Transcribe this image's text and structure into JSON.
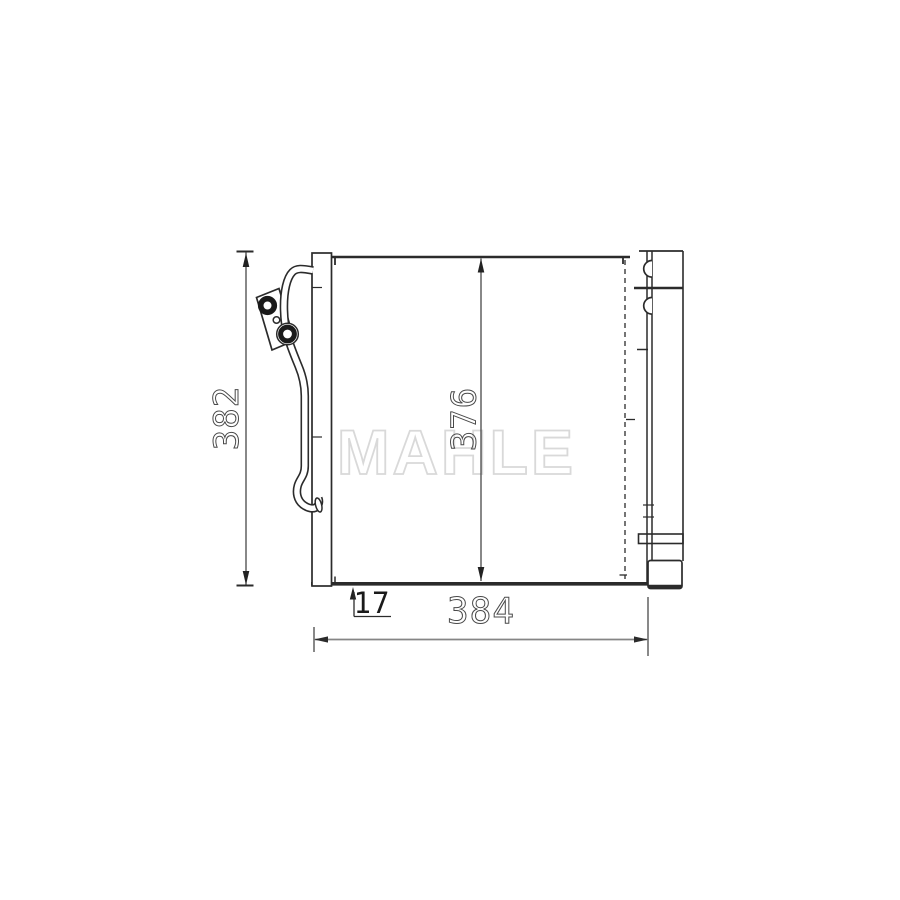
{
  "drawing": {
    "watermark": "MAHLE",
    "dimensions": {
      "overall_height": "382",
      "core_height": "376",
      "overall_width": "384",
      "bottom_offset": "17"
    },
    "colors": {
      "line": "#2b2b2b",
      "dimension_text": "#4a4a4a",
      "solid_text": "#1a1a1a",
      "baseline_gray": "#858585",
      "watermark": "#d9d9d9"
    }
  }
}
